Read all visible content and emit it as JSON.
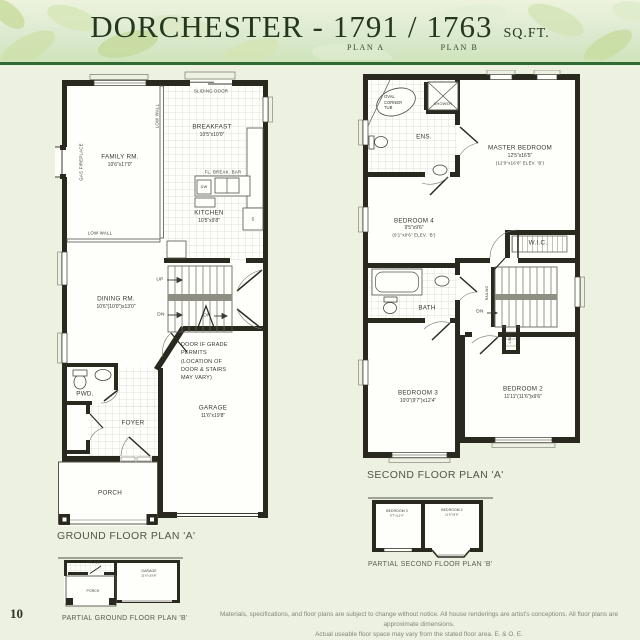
{
  "header": {
    "name": "DORCHESTER",
    "dash": "-",
    "plan_a_value": "1791",
    "slash": "/",
    "plan_b_value": "1763",
    "sqft": "SQ.FT.",
    "plan_a_label": "PLAN A",
    "plan_b_label": "PLAN B"
  },
  "page_number": "10",
  "colors": {
    "page_bg": "#ecf1e1",
    "header_rule": "#2f6b31",
    "title_green": "#24381f",
    "wall_black": "#29291f"
  },
  "gf": {
    "caption": "GROUND FLOOR PLAN 'A'",
    "sliding_door": "SLIDING DOOR",
    "low_wall_top": "LOW WALL",
    "low_wall_bottom": "LOW WALL",
    "gas_fireplace": "GAS FIREPLACE",
    "breakfast": "BREAKFAST",
    "breakfast_dim": "10'5\"x10'0\"",
    "family": "FAMILY RM.",
    "family_dim": "10'6\"x17'0\"",
    "fl_break_bar": "FL. BREAK. BAR",
    "dw": "DW",
    "s": "S",
    "kitchen": "KITCHEN",
    "kitchen_dim": "10'5\"x9'8\"",
    "dining": "DINING RM.",
    "dining_dim": "10'6\"(10'0\")x13'0\"",
    "up": "UP",
    "dn1": "DN",
    "dn2": "DN",
    "grade_note": "DOOR IF GRADE PERMITS (LOCATION OF DOOR & STAIRS MAY VARY)",
    "pwd": "PWD.",
    "foyer": "FOYER",
    "garage": "GARAGE",
    "garage_dim": "11'6\"x19'8\"",
    "porch": "PORCH"
  },
  "sf": {
    "caption": "SECOND FLOOR PLAN 'A'",
    "tub_note": "OVAL CORNER TUB",
    "shower": "SHOWER",
    "ens": "ENS.",
    "master": "MASTER BEDROOM",
    "master_dim1": "12'5\"x16'5\"",
    "master_dim2": "(12'0\"x16'0\" ELEV. 'B')",
    "bedroom4": "BEDROOM 4",
    "bedroom4_dim1": "9'5\"x9'6\"",
    "bedroom4_dim2": "(9'1\"x9'6\" ELEV. 'B')",
    "wic": "W.I.C.",
    "bath": "BATH",
    "railing": "RAILING",
    "dn": "DN",
    "linen": "LINEN",
    "bedroom3": "BEDROOM 3",
    "bedroom3_dim": "10'0\"(9'7\")x12'4\"",
    "bedroom2": "BEDROOM 2",
    "bedroom2_dim": "11'11\"(11'6\")x9'6\""
  },
  "psf": {
    "caption": "PARTIAL SECOND FLOOR PLAN 'B'",
    "bedroom3": "BEDROOM 3",
    "bedroom3_dim": "9'7\"x12'4\"",
    "bedroom2": "BEDROOM 2",
    "bedroom2_dim": "11'6\"x9'6\""
  },
  "pgf": {
    "caption": "PARTIAL GROUND FLOOR PLAN 'B'",
    "foyer": "FOYER",
    "porch": "PORCH",
    "garage": "GARAGE",
    "garage_dim": "11'6\"x19'8\""
  },
  "footer": {
    "disclaimer_line1": "Materials, specifications, and floor plans are subject to change without notice. All house renderings are artist's conceptions. All floor plans are approximate dimensions.",
    "disclaimer_line2": "Actual useable floor space may vary from the stated floor area. E. & O. E."
  }
}
